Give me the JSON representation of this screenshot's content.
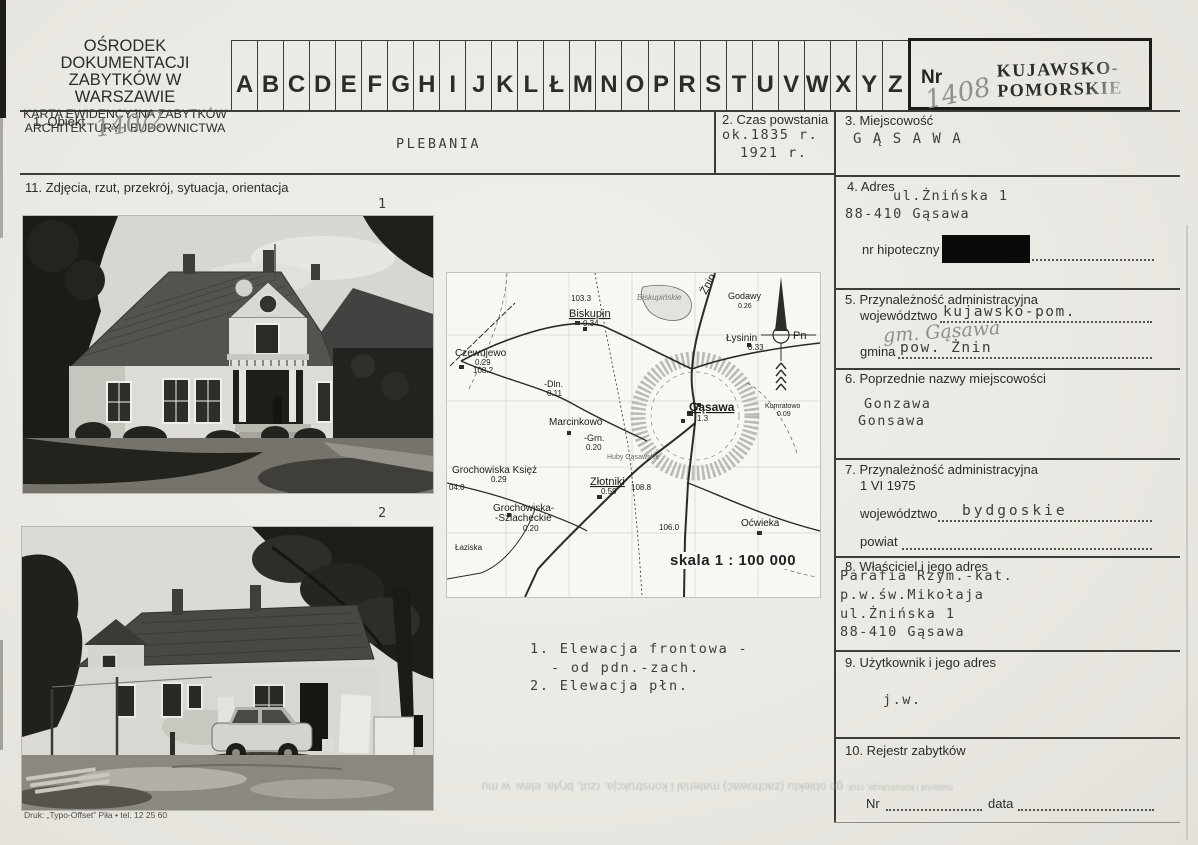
{
  "header": {
    "org1": "OŚRODEK DOKUMENTACJI",
    "org2": "ZABYTKÓW W WARSZAWIE",
    "org3": "KARTA EWIDENCYJNA ZABYTKÓW",
    "org4": "ARCHITEKTURY I BUDOWNICTWA",
    "alphabet": [
      "A",
      "B",
      "C",
      "D",
      "E",
      "F",
      "G",
      "H",
      "I",
      "J",
      "K",
      "L",
      "Ł",
      "M",
      "N",
      "O",
      "P",
      "R",
      "S",
      "T",
      "U",
      "V",
      "W",
      "X",
      "Y",
      "Z"
    ],
    "nr_label": "Nr",
    "nr_value": "1408",
    "stamp1": "KUJAWSKO-",
    "stamp2": "POMORSKIE"
  },
  "fields": {
    "f1": {
      "label": "1. Obiekt",
      "annotation": "140/2",
      "value": "PLEBANIA"
    },
    "f2": {
      "label": "2. Czas powstania",
      "l1": "ok.1835 r.",
      "l2": "1921 r."
    },
    "f3": {
      "label": "3. Miejscowość",
      "value": "G Ą S A W A"
    },
    "f4": {
      "label": "4. Adres",
      "l1": "ul.Żnińska 1",
      "l2": "88-410 Gąsawa",
      "hip_label": "nr hipoteczny"
    },
    "f5": {
      "label": "5. Przynależność administracyjna",
      "woj_label": "województwo",
      "woj_value": "kujawsko-pom.",
      "handwritten": "gm. Gąsawa",
      "gmina_label": "gmina",
      "gmina_value": "pow. Żnin"
    },
    "f6": {
      "label": "6. Poprzednie nazwy miejscowości",
      "l1": "Gonzawa",
      "l2": "Gonsawa"
    },
    "f7": {
      "label": "7. Przynależność administracyjna",
      "date": "1 VI 1975",
      "woj_label": "województwo",
      "woj_value": "bydgoskie",
      "powiat_label": "powiat"
    },
    "f8": {
      "label": "8. Właściciel i jego adres",
      "lines": [
        "Parafia Rzym.-kat.",
        "p.w.św.Mikołaja",
        "ul.Żnińska 1",
        "88-410 Gąsawa"
      ]
    },
    "f9": {
      "label": "9. Użytkownik i jego adres",
      "value": "j.w."
    },
    "f10": {
      "label": "10. Rejestr zabytków",
      "nr_label": "Nr",
      "data_label": "data"
    },
    "f11": {
      "label": "11. Zdjęcia, rzut, przekrój, sytuacja, orientacja"
    }
  },
  "photos": {
    "n1": "1",
    "n2": "2",
    "cap1": "1. Elewacja frontowa -",
    "cap2": "- od pdn.-zach.",
    "cap3": "2. Elewacja płn."
  },
  "map": {
    "scale": "skala 1 : 100 000",
    "north_label": "Pn",
    "places": [
      {
        "t": "Żnin",
        "x": 259,
        "y": 22,
        "s": 11,
        "r": -62
      },
      {
        "t": "Godawy",
        "x": 281,
        "y": 26,
        "s": 9
      },
      {
        "t": "0.26",
        "x": 291,
        "y": 35,
        "s": 7
      },
      {
        "t": "103.3",
        "x": 124,
        "y": 28,
        "s": 8
      },
      {
        "t": "Biskupin",
        "x": 122,
        "y": 44,
        "s": 11,
        "u": 1
      },
      {
        "t": "0.34",
        "x": 136,
        "y": 53,
        "s": 8
      },
      {
        "t": "Biskupińskie",
        "x": 190,
        "y": 27,
        "s": 8,
        "i": 1,
        "c": "#77776f"
      },
      {
        "t": "Czewujewo",
        "x": 8,
        "y": 83,
        "s": 10
      },
      {
        "t": "0.29",
        "x": 28,
        "y": 92,
        "s": 8
      },
      {
        "t": "108.2",
        "x": 26,
        "y": 100,
        "s": 8
      },
      {
        "t": "-Dln.",
        "x": 97,
        "y": 114,
        "s": 9
      },
      {
        "t": "0.11",
        "x": 100,
        "y": 123,
        "s": 8
      },
      {
        "t": "Łysinin",
        "x": 279,
        "y": 68,
        "s": 10
      },
      {
        "t": "0.33",
        "x": 301,
        "y": 77,
        "s": 8
      },
      {
        "t": "Gąsawa",
        "x": 242,
        "y": 138,
        "s": 12,
        "u": 1,
        "b": 1
      },
      {
        "t": "1.3",
        "x": 250,
        "y": 148,
        "s": 8
      },
      {
        "t": "Komratowo",
        "x": 318,
        "y": 135,
        "s": 7
      },
      {
        "t": "0.09",
        "x": 330,
        "y": 143,
        "s": 7
      },
      {
        "t": "Marcinkowo",
        "x": 102,
        "y": 152,
        "s": 10
      },
      {
        "t": "-Grn.",
        "x": 137,
        "y": 168,
        "s": 9
      },
      {
        "t": "0.20",
        "x": 139,
        "y": 177,
        "s": 8
      },
      {
        "t": "Huby Gąsawskie",
        "x": 160,
        "y": 186,
        "s": 7,
        "c": "#6d6d66"
      },
      {
        "t": "Grochowiska Księż",
        "x": 5,
        "y": 200,
        "s": 10
      },
      {
        "t": "0.29",
        "x": 44,
        "y": 209,
        "s": 8
      },
      {
        "t": "04.0",
        "x": 2,
        "y": 217,
        "s": 8
      },
      {
        "t": "Złotniki",
        "x": 143,
        "y": 212,
        "s": 11,
        "u": 1
      },
      {
        "t": "0.59",
        "x": 154,
        "y": 221,
        "s": 8
      },
      {
        "t": "108.8",
        "x": 184,
        "y": 217,
        "s": 8
      },
      {
        "t": "Grochowiska-",
        "x": 46,
        "y": 238,
        "s": 10
      },
      {
        "t": "-Szlacheckie",
        "x": 48,
        "y": 248,
        "s": 10
      },
      {
        "t": "0.20",
        "x": 76,
        "y": 258,
        "s": 8
      },
      {
        "t": "Łaziska",
        "x": 8,
        "y": 277,
        "s": 8
      },
      {
        "t": "106.0",
        "x": 212,
        "y": 257,
        "s": 8
      },
      {
        "t": "Oćwieka",
        "x": 294,
        "y": 253,
        "s": 10
      },
      {
        "t": "Pn",
        "x": 346,
        "y": 66,
        "s": 11
      }
    ]
  },
  "footer": {
    "print_info": "Druk: „Typo-Offset” Piła • tel. 12 25 60",
    "bleed1": "go obiektu (zachować) materiał i konstrukcja, rzut, bryła, elew. w mu",
    "bleed2": "materiał i konstrukcja, rzut."
  }
}
